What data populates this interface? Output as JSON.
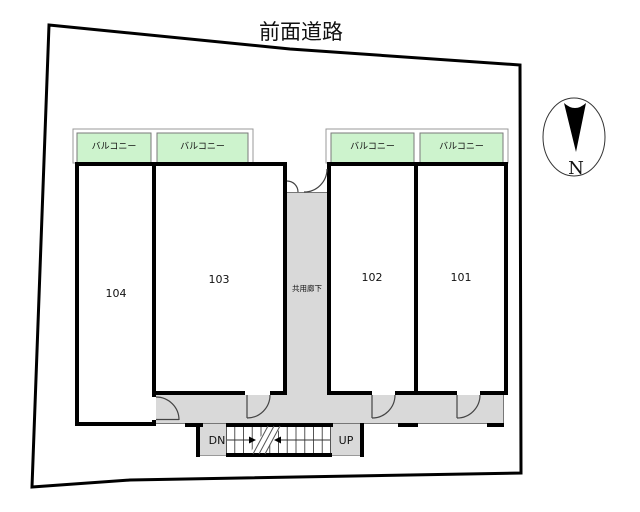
{
  "plan": {
    "road_label": "前面道路",
    "corridor_label": "共用廊下",
    "balcony_labels": [
      "バルコニー",
      "バルコニー",
      "バルコニー",
      "バルコニー"
    ],
    "rooms": [
      {
        "number": "104"
      },
      {
        "number": "103"
      },
      {
        "number": "102"
      },
      {
        "number": "101"
      }
    ],
    "stairs": {
      "down": "DN",
      "up": "UP"
    },
    "compass": {
      "north": "N"
    }
  },
  "colors": {
    "balcony_fill": "#cdf3cd",
    "corridor_fill": "#d9d9d9",
    "wall": "#000000",
    "line": "#444444"
  }
}
